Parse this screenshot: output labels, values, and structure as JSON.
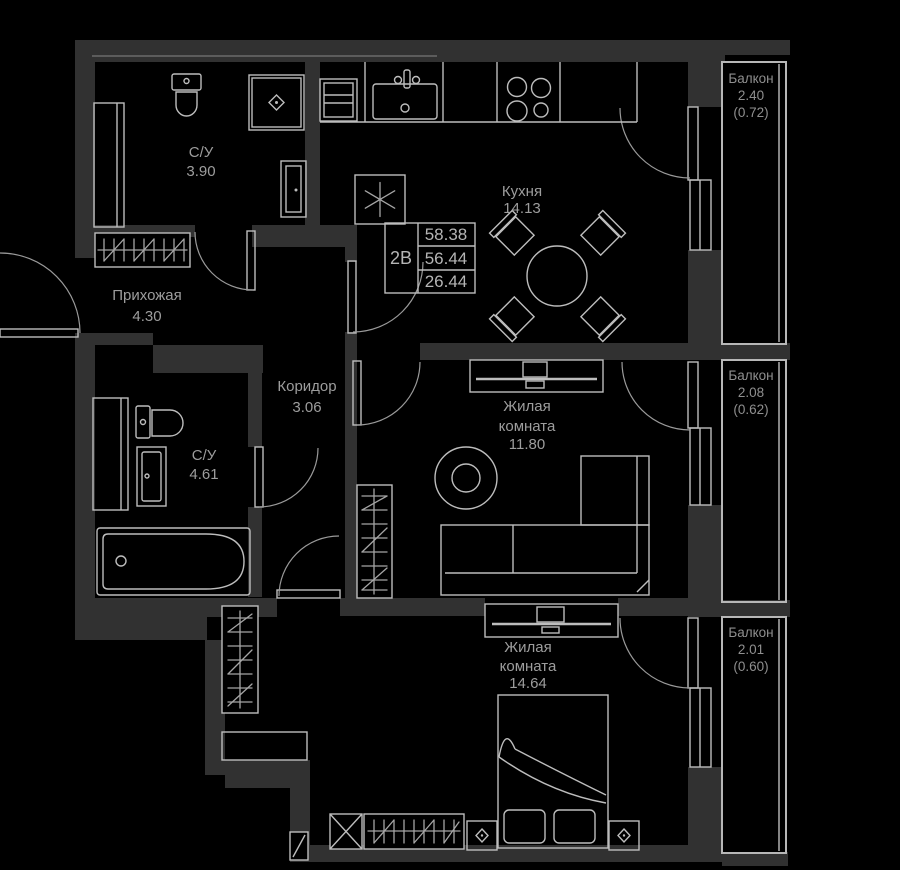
{
  "plan_info": {
    "unit_type": "2В",
    "total_area": "58.38",
    "area_without_balconies": "56.44",
    "living_area": "26.44"
  },
  "rooms": [
    {
      "name": "С/У",
      "area": "3.90"
    },
    {
      "name": "Прихожая",
      "area": "4.30"
    },
    {
      "name": "Кухня",
      "area": "14.13"
    },
    {
      "name": "Коридор",
      "area": "3.06"
    },
    {
      "name": "С/У",
      "area": "4.61"
    },
    {
      "name_line1": "Жилая",
      "name_line2": "комната",
      "area": "11.80"
    },
    {
      "name_line1": "Жилая",
      "name_line2": "комната",
      "area": "14.64"
    }
  ],
  "balconies": [
    {
      "name": "Балкон",
      "area": "2.40",
      "reduced_area": "(0.72)"
    },
    {
      "name": "Балкон",
      "area": "2.08",
      "reduced_area": "(0.62)"
    },
    {
      "name": "Балкон",
      "area": "2.01",
      "reduced_area": "(0.60)"
    }
  ],
  "colors": {
    "background": "#000000",
    "walls": "#313131",
    "lines": "#bdbdbd",
    "text": "#9d9d9d"
  }
}
